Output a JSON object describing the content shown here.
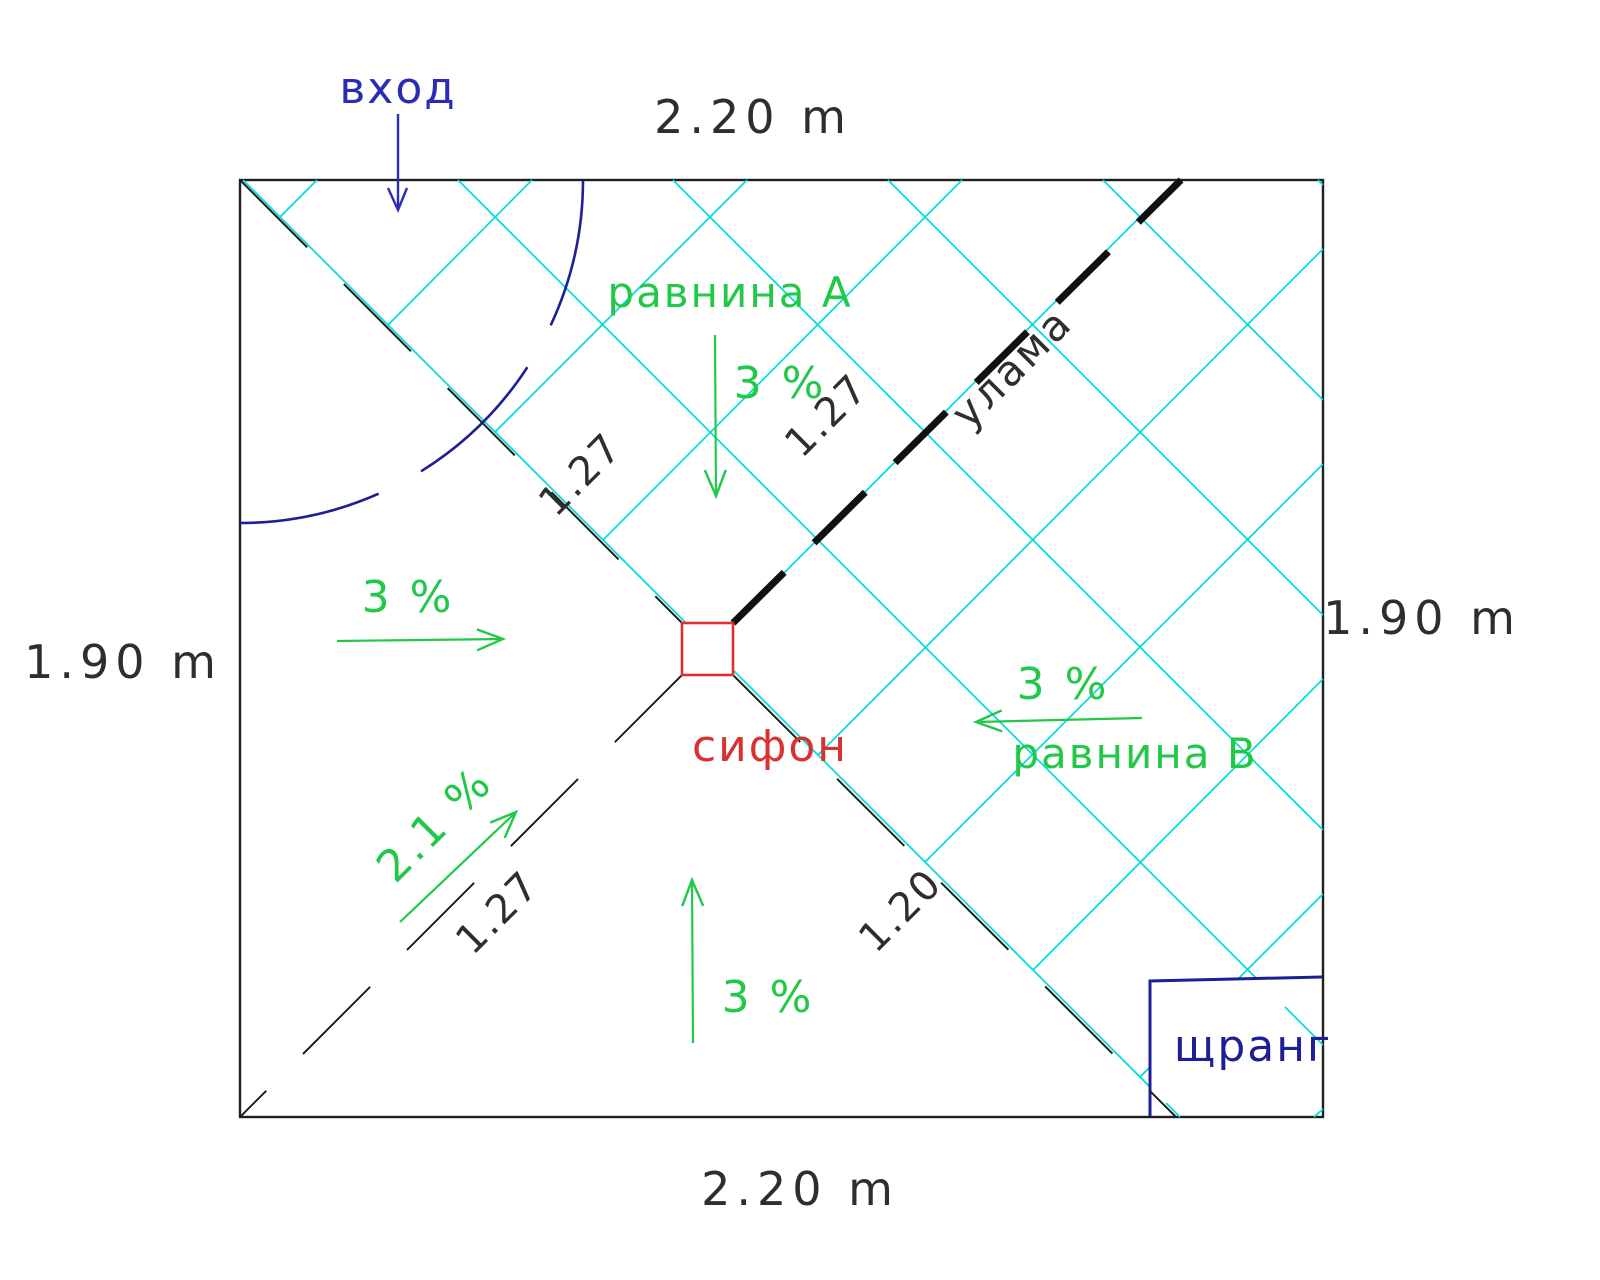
{
  "title": "floor slope plan",
  "colors": {
    "wall": "#1f1f1f",
    "hip": "#1f1f1f",
    "valley": "#111111",
    "grid": "#00dcdc",
    "green": "#22c847",
    "blue": "#2b2bb4",
    "navy": "#1e1e96",
    "red": "#d93030",
    "dimtext": "#2e2e2e"
  },
  "dimensions": {
    "top": "2.20 m",
    "bottom": "2.20 m",
    "left": "1.90 m",
    "right": "1.90 m"
  },
  "labels": {
    "entrance": "вход",
    "valley": "улама",
    "drain": "сифон",
    "riser": "щранг"
  },
  "plane_a": {
    "name": "равнина A",
    "slope": "3 %"
  },
  "plane_b": {
    "name": "равнина B",
    "slope": "3 %"
  },
  "slopes": {
    "left": "3 %",
    "bottom": "3 %",
    "diagonal": "2.1 %"
  },
  "lengths": {
    "hip_top_left": "1.27",
    "valley": "1.27",
    "hip_bottom_left": "1.27",
    "hip_bottom_right": "1.20"
  }
}
